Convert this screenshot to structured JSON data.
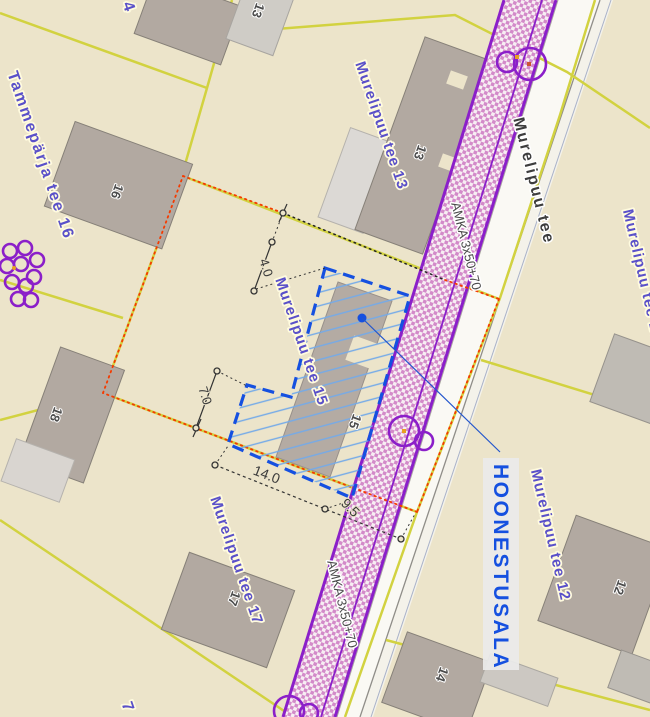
{
  "map": {
    "colors": {
      "background": "#ece4ca",
      "parcel_line_yellow": "#d2d240",
      "boundary_red": "#f43b00",
      "corridor_purple": "#8b1fc9",
      "area_blue": "#1550e0",
      "label_purple": "#5a50c9",
      "building_fill": "#b2a9a1",
      "street_text": "#3d3d3d"
    },
    "street": {
      "name": "Murelipuu tee"
    },
    "parcels": {
      "tammeparja_16": "Tammepärja tee 16",
      "murelipuu_13": "Murelipuu tee 13",
      "murelipuu_15": "Murelipuu tee 15",
      "murelipuu_17": "Murelipuu tee 17",
      "murelipuu_10": "Murelipuu tee 10",
      "murelipuu_12": "Murelipuu tee 12",
      "partial_top": "4",
      "partial_bottom": "7"
    },
    "utility": {
      "cable_label_upper": "AMKA 3x50+70",
      "cable_label_lower": "AMKA 3x50+70"
    },
    "annotation": {
      "building_area_label": "HOONESTUSALA"
    },
    "house_numbers": {
      "top_partial": "13",
      "n13": "13",
      "n15": "15",
      "n16": "16",
      "n17": "17",
      "n18": "18",
      "n12": "12",
      "n14": "14"
    },
    "dimensions": {
      "offset_top": "4.0",
      "offset_left": "7.0",
      "width_bottom": "14.0",
      "road_gap": "9.5"
    }
  }
}
